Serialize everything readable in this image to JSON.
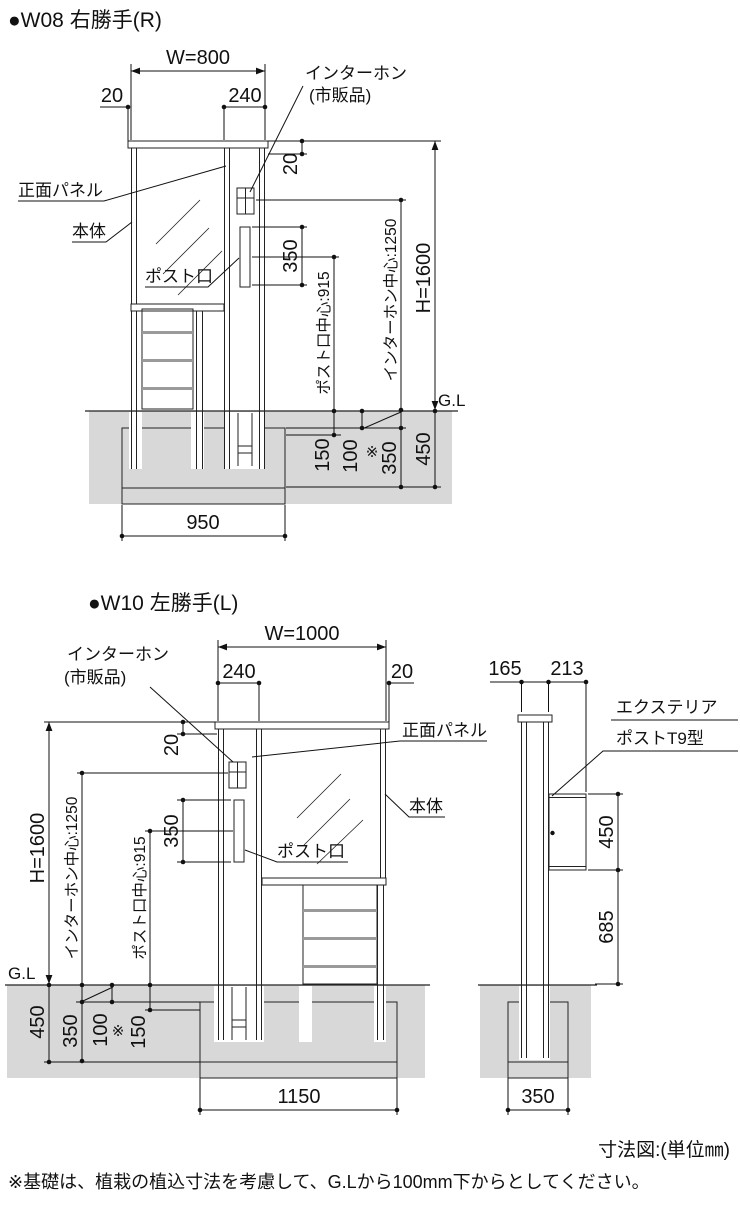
{
  "colors": {
    "line": "#222222",
    "ground": "#d8d8d8",
    "hatch": "#4d4d4d",
    "rail": "#9a9a9a"
  },
  "w08": {
    "title": "●W08 右勝手(R)",
    "dims": {
      "width": "W=800",
      "side_offset": "20",
      "column_width": "240",
      "top_offset": "20",
      "slot_height": "350",
      "slot_center": "ポスト口中心:915",
      "intercom_center": "インターホン中心:1250",
      "height": "H=1600",
      "ground_line": "G.L",
      "embed_depth": "150",
      "base_offset": "100",
      "ref_mark": "※",
      "base_depth": "350",
      "total_depth": "450",
      "base_width": "950"
    },
    "labels": {
      "intercom_1": "インターホン",
      "intercom_2": "(市販品)",
      "front_panel": "正面パネル",
      "body": "本体",
      "post_slot": "ポスト口"
    }
  },
  "w10": {
    "title": "●W10 左勝手(L)",
    "dims": {
      "width": "W=1000",
      "side_offset": "20",
      "column_width": "240",
      "top_offset": "20",
      "slot_height": "350",
      "slot_center": "ポスト口中心:915",
      "intercom_center": "インターホン中心:1250",
      "height": "H=1600",
      "ground_line": "G.L",
      "embed_depth": "150",
      "base_offset": "100",
      "ref_mark": "※",
      "base_depth": "350",
      "total_depth": "450",
      "base_width": "1150"
    },
    "labels": {
      "intercom_1": "インターホン",
      "intercom_2": "(市販品)",
      "front_panel": "正面パネル",
      "body": "本体",
      "post_slot": "ポスト口"
    }
  },
  "side_view": {
    "dims": {
      "post_depth": "165",
      "box_depth": "213",
      "box_height": "450",
      "below_box": "685",
      "base_width": "350"
    },
    "labels": {
      "product_1": "エクステリア",
      "product_2": "ポストT9型"
    }
  },
  "footer": {
    "unit_note": "寸法図:(単位㎜)",
    "base_note": "※基礎は、植栽の植込寸法を考慮して、G.Lから100mm下からとしてください。"
  }
}
